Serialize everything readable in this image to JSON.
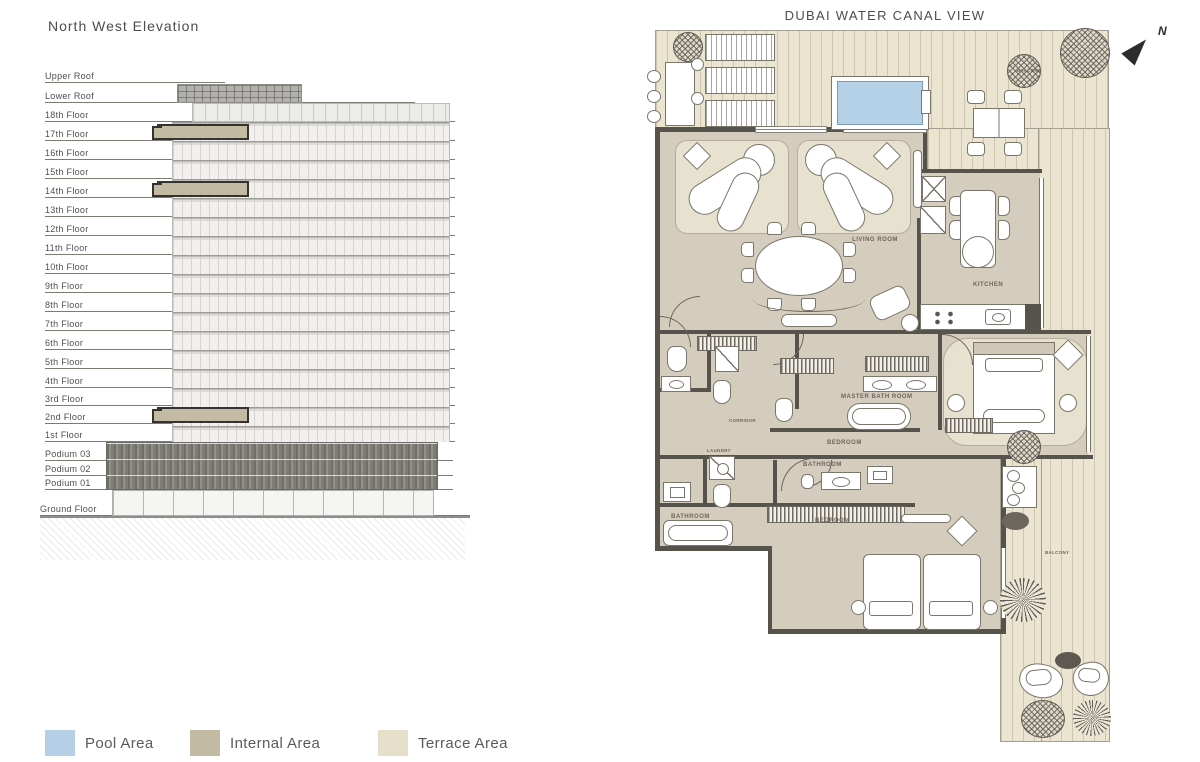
{
  "elevation": {
    "title": "North West Elevation",
    "floors": [
      "Upper Roof",
      "Lower Roof",
      "18th Floor",
      "17th Floor",
      "16th Floor",
      "15th Floor",
      "14th Floor",
      "13th Floor",
      "12th Floor",
      "11th Floor",
      "10th Floor",
      "9th Floor",
      "8th Floor",
      "7th Floor",
      "6th Floor",
      "5th Floor",
      "4th Floor",
      "3rd Floor",
      "2nd Floor",
      "1st Floor",
      "Podium 03",
      "Podium 02",
      "Podium 01",
      "Ground Floor"
    ]
  },
  "legend": {
    "items": [
      {
        "label": "Pool Area",
        "color": "#b5cfe6"
      },
      {
        "label": "Internal Area",
        "color": "#c3baa4"
      },
      {
        "label": "Terrace Area",
        "color": "#e6dfc9"
      }
    ]
  },
  "plan": {
    "title": "DUBAI WATER CANAL VIEW",
    "north_label": "N",
    "colors": {
      "internal": "#d4cdbe",
      "terrace": "#eae4d1",
      "pool": "#b5d1e8",
      "wall": "#56524c"
    },
    "rooms": {
      "living_room": "LIVING ROOM",
      "kitchen": "KITCHEN",
      "master_bathroom": "MASTER BATH ROOM",
      "master_bedroom": "BEDROOM",
      "bedroom": "BEDROOM",
      "bathroom_middle": "BATHROOM",
      "bathroom_left": "BATHROOM",
      "corridor": "CORRIDOR",
      "laundry": "LAUNDRY",
      "balcony_top": "BALCONY",
      "balcony_right": "BALCONY"
    }
  }
}
